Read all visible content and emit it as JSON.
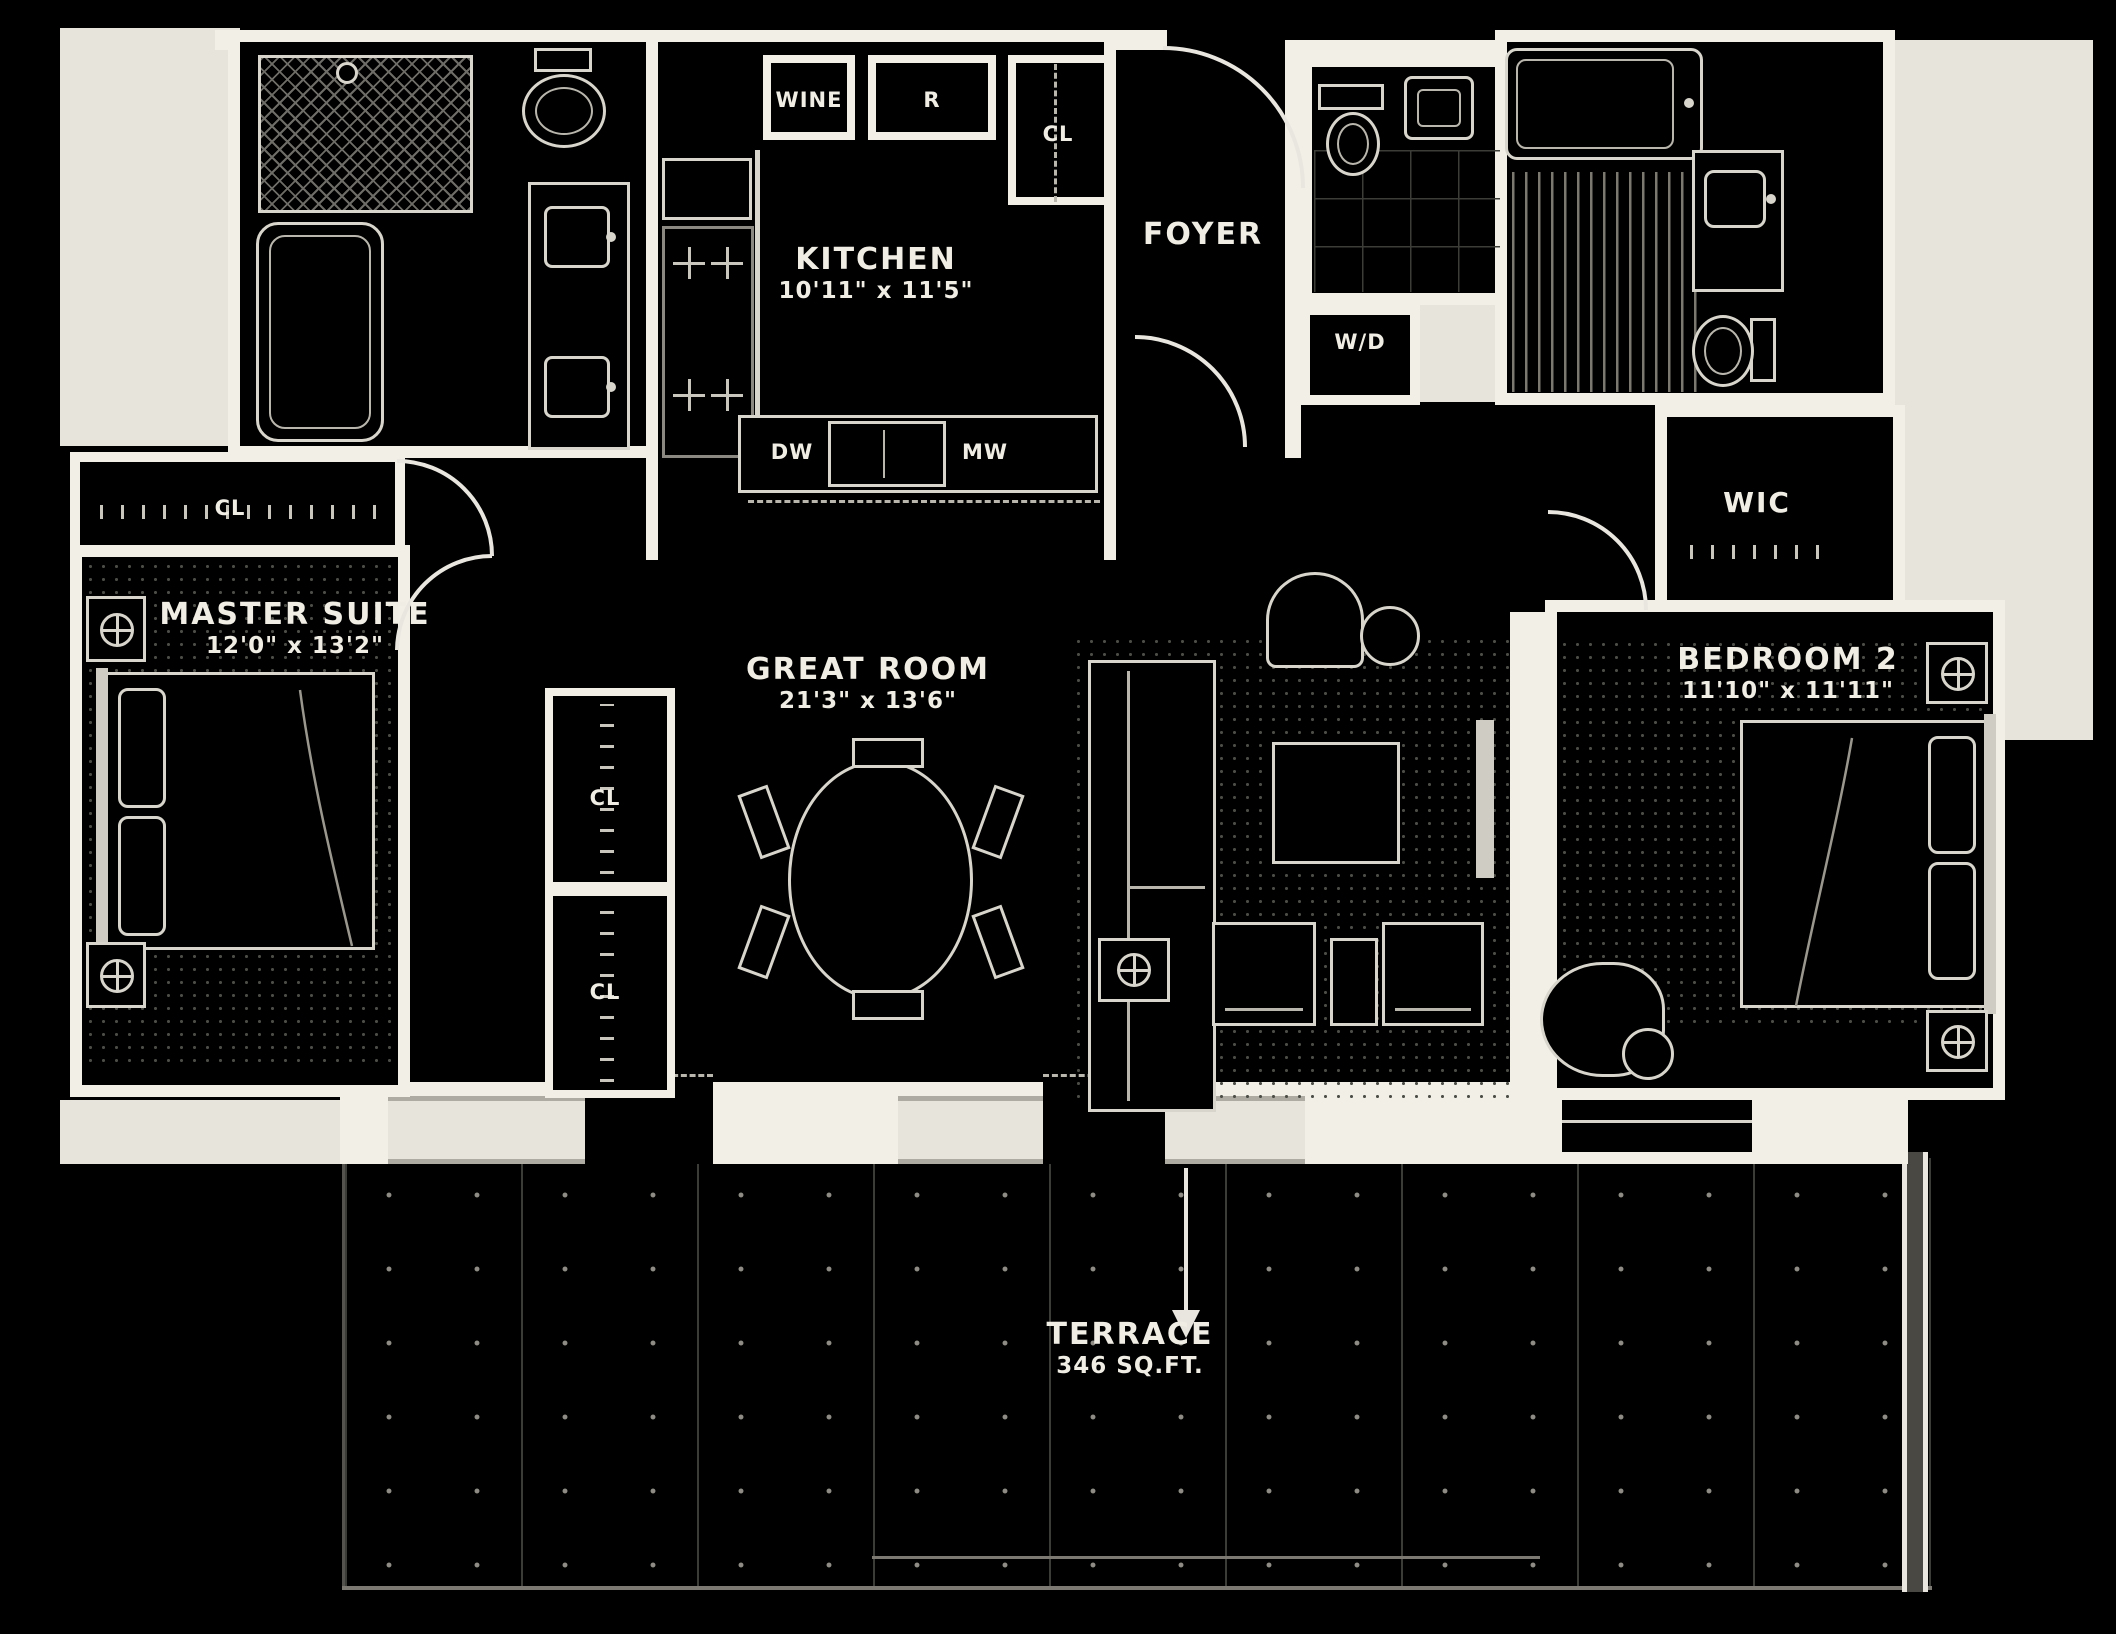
{
  "plan_type": "apartment-floor-plan",
  "colors": {
    "background": "#000000",
    "walls": "#f2efe7",
    "exterior_mask": "#e7e4db",
    "furniture_line": "#d8d5cc",
    "rug_speckle": "#4d4d47",
    "label_text": "#f0ede4"
  },
  "rooms": {
    "kitchen": {
      "name": "KITCHEN",
      "dims": "10'11\" x 11'5\""
    },
    "foyer": {
      "name": "FOYER"
    },
    "master_suite": {
      "name": "MASTER SUITE",
      "dims": "12'0\" x 13'2\""
    },
    "great_room": {
      "name": "GREAT ROOM",
      "dims": "21'3\" x 13'6\""
    },
    "bedroom_2": {
      "name": "BEDROOM 2",
      "dims": "11'10\" x 11'11\""
    },
    "wic": {
      "name": "WIC"
    },
    "terrace": {
      "name": "TERRACE",
      "area": "346 SQ.FT."
    }
  },
  "labels": {
    "wine": "WINE",
    "refrigerator": "R",
    "foyer_closet": "CL",
    "master_closet": "CL",
    "hall_closet_upper": "CL",
    "hall_closet_lower": "CL",
    "washer_dryer": "W/D",
    "dishwasher": "DW",
    "microwave": "MW"
  }
}
